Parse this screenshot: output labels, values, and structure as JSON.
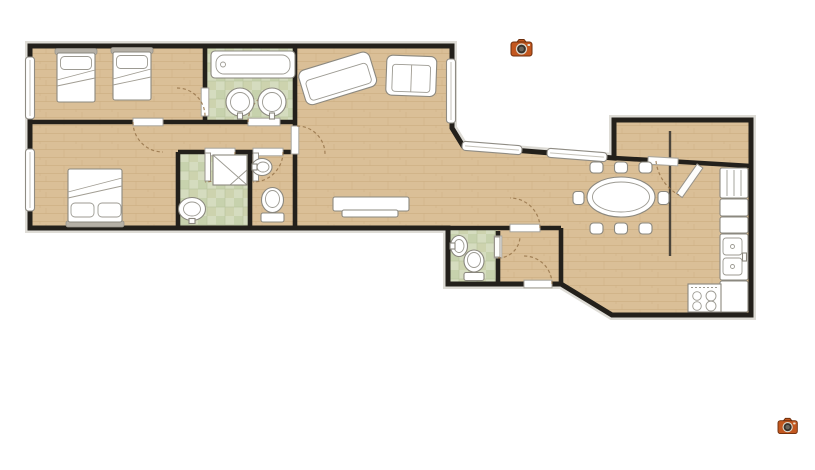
{
  "meta": {
    "description": "Apartment floor plan with two photo camera hotspots",
    "canvas": {
      "width": 815,
      "height": 470
    },
    "background": "#ffffff"
  },
  "colors": {
    "wall": "#23201b",
    "shadow": "#d3d0c8",
    "floor-wood": "#dabf97",
    "floor-wood-grain": "#c8a97c",
    "tile-base": "#d5dcbf",
    "tile-alt": "#c7d2ad",
    "tile-grid": "#b7c29c",
    "fixture-stroke": "#8b887f",
    "door-arc": "#96744a",
    "divider": "#4a443b",
    "camera-body": "#c2571f",
    "camera-lens": "#37322c"
  },
  "hotspots": {
    "count": 2,
    "items": [
      {
        "name": "camera-hotspot-top",
        "x": 511,
        "y": 38
      },
      {
        "name": "camera-hotspot-bottom",
        "x": 778,
        "y": 417
      }
    ]
  },
  "floor_plan": {
    "rooms": [
      {
        "name": "bedroom-twin",
        "fixtures": [
          "single-bed",
          "single-bed",
          "window"
        ]
      },
      {
        "name": "family-bathroom",
        "fixtures": [
          "bathtub",
          "round-sink",
          "round-sink"
        ],
        "floor": "tile"
      },
      {
        "name": "living-room",
        "fixtures": [
          "large-sofa",
          "small-sofa",
          "sideboard-tv",
          "window"
        ]
      },
      {
        "name": "bedroom-double",
        "fixtures": [
          "double-bed",
          "window"
        ]
      },
      {
        "name": "shower-room",
        "fixtures": [
          "shower-stall",
          "pedestal-sink"
        ],
        "floor": "tile"
      },
      {
        "name": "wc",
        "fixtures": [
          "wall-sink",
          "toilet"
        ]
      },
      {
        "name": "hallway",
        "fixtures": []
      },
      {
        "name": "guest-wc",
        "fixtures": [
          "wall-sink",
          "toilet"
        ],
        "floor": "tile"
      },
      {
        "name": "inner-hall",
        "fixtures": []
      },
      {
        "name": "dining-area",
        "fixtures": [
          "oval-table"
        ],
        "chairs": 8,
        "windows": 2
      },
      {
        "name": "kitchen",
        "fixtures": [
          "fridge",
          "cabinets",
          "double-sink",
          "stove"
        ],
        "burners": 4
      },
      {
        "name": "entry-room",
        "fixtures": []
      }
    ],
    "door_count": 11,
    "window_count": 5
  }
}
